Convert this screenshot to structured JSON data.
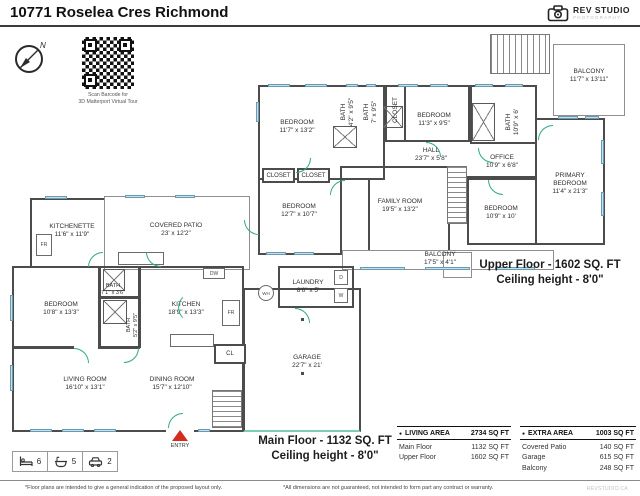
{
  "header": {
    "title": "10771 Roselea Cres Richmond",
    "logo_line1": "REV STUDIO",
    "logo_line2": "PHOTOGRAPHY"
  },
  "compass": {
    "north": "N"
  },
  "qr": {
    "caption1": "Scan Barcode for",
    "caption2": "3D Matterport Virtual Tour"
  },
  "upper": {
    "title": "Upper Floor - 1602 SQ. FT",
    "ceiling": "Ceiling height - 8'0\"",
    "rooms": [
      {
        "name": "BEDROOM",
        "dims": "11'7\" x 13'2\""
      },
      {
        "name": "BATH",
        "dims": "4'2\" x 9'5\""
      },
      {
        "name": "BATH",
        "dims": "7' x 9'5\""
      },
      {
        "name": "CLOSET",
        "dims": ""
      },
      {
        "name": "BEDROOM",
        "dims": "11'3\" x 9'5\""
      },
      {
        "name": "BATH",
        "dims": "10'9\" x 6'"
      },
      {
        "name": "HALL",
        "dims": "23'7\" x 5'8\""
      },
      {
        "name": "OFFICE",
        "dims": "10'9\" x 6'8\""
      },
      {
        "name": "PRIMARY BEDROOM",
        "dims": "11'4\" x 21'3\""
      },
      {
        "name": "BEDROOM",
        "dims": "10'9\" x 10'"
      },
      {
        "name": "CLOSET",
        "dims": ""
      },
      {
        "name": "CLOSET",
        "dims": ""
      },
      {
        "name": "BEDROOM",
        "dims": "12'7\" x 10'7\""
      },
      {
        "name": "FAMILY ROOM",
        "dims": "19'5\" x 13'2\""
      },
      {
        "name": "BALCONY",
        "dims": "17'5\" x 4'1\""
      },
      {
        "name": "BALCONY",
        "dims": "11'7\" x 13'11\""
      }
    ]
  },
  "main": {
    "title": "Main Floor - 1132 SQ. FT",
    "ceiling": "Ceiling height - 8'0\"",
    "entry_label": "ENTRY",
    "rooms": [
      {
        "name": "KITCHENETTE",
        "dims": "11'6\" x 11'9\""
      },
      {
        "name": "COVERED PATIO",
        "dims": "23' x 12'2\""
      },
      {
        "name": "BATH",
        "dims": "7'1\" x 3'6\""
      },
      {
        "name": "BEDROOM",
        "dims": "10'8\" x 13'3\""
      },
      {
        "name": "BATH",
        "dims": "5'2\" x 9'5\""
      },
      {
        "name": "KITCHEN",
        "dims": "18'9\" x 13'3\""
      },
      {
        "name": "LIVING ROOM",
        "dims": "16'10\" x 13'1\""
      },
      {
        "name": "DINING ROOM",
        "dims": "15'7\" x 12'10\""
      },
      {
        "name": "LAUNDRY",
        "dims": "8'6\" x 5'"
      },
      {
        "name": "GARAGE",
        "dims": "22'7\" x 21'"
      },
      {
        "name": "CL",
        "dims": ""
      }
    ]
  },
  "fixtures": {
    "fr": "FR",
    "dw": "DW",
    "wh": "WH",
    "washer": "W",
    "dryer": "D"
  },
  "stats": {
    "beds": "6",
    "baths": "5",
    "cars": "2"
  },
  "tables": {
    "bullet": "●",
    "living": {
      "header": "LIVING AREA",
      "total": "2734 SQ FT",
      "rows": [
        {
          "label": "Main Floor",
          "value": "1132 SQ FT"
        },
        {
          "label": "Upper Floor",
          "value": "1602 SQ FT"
        }
      ]
    },
    "extra": {
      "header": "EXTRA AREA",
      "total": "1003 SQ FT",
      "rows": [
        {
          "label": "Covered Patio",
          "value": "140 SQ FT"
        },
        {
          "label": "Garage",
          "value": "615 SQ FT"
        },
        {
          "label": "Balcony",
          "value": "248 SQ FT"
        }
      ]
    }
  },
  "footer": {
    "left": "*Floor plans are intended to give a general indication of the proposed layout only.",
    "right": "*All dimensions are not guaranteed, not intended to form part any contract or warranty.",
    "brand": "REVSTUDIO.CA"
  }
}
